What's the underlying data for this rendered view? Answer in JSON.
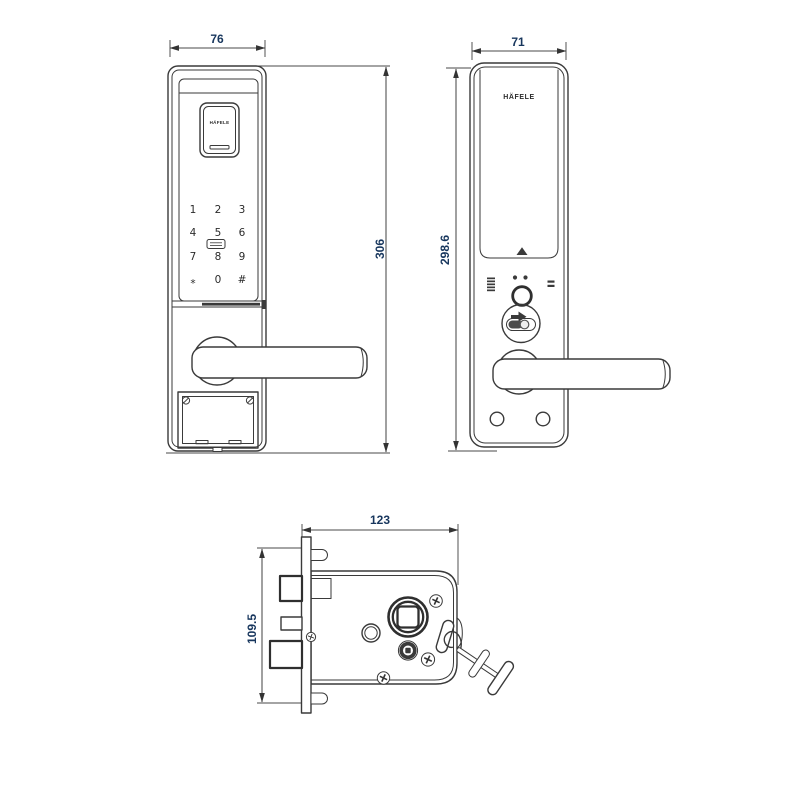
{
  "drawing": {
    "brand": "HÄFELE",
    "colors": {
      "line": "#3a3a3a",
      "dimension_text": "#17365d",
      "background": "#ffffff"
    },
    "front_view": {
      "width_dim": "76",
      "height_dim": "306",
      "module_logo": "HÄFELE",
      "keypad": {
        "keys": [
          "1",
          "2",
          "3",
          "4",
          "5",
          "6",
          "7",
          "8",
          "9",
          "*",
          "0",
          "#"
        ]
      }
    },
    "back_view": {
      "width_dim": "71",
      "height_dim": "298.6",
      "logo": "HÄFELE"
    },
    "mortise_view": {
      "width_dim": "123",
      "height_dim": "109.5"
    }
  }
}
